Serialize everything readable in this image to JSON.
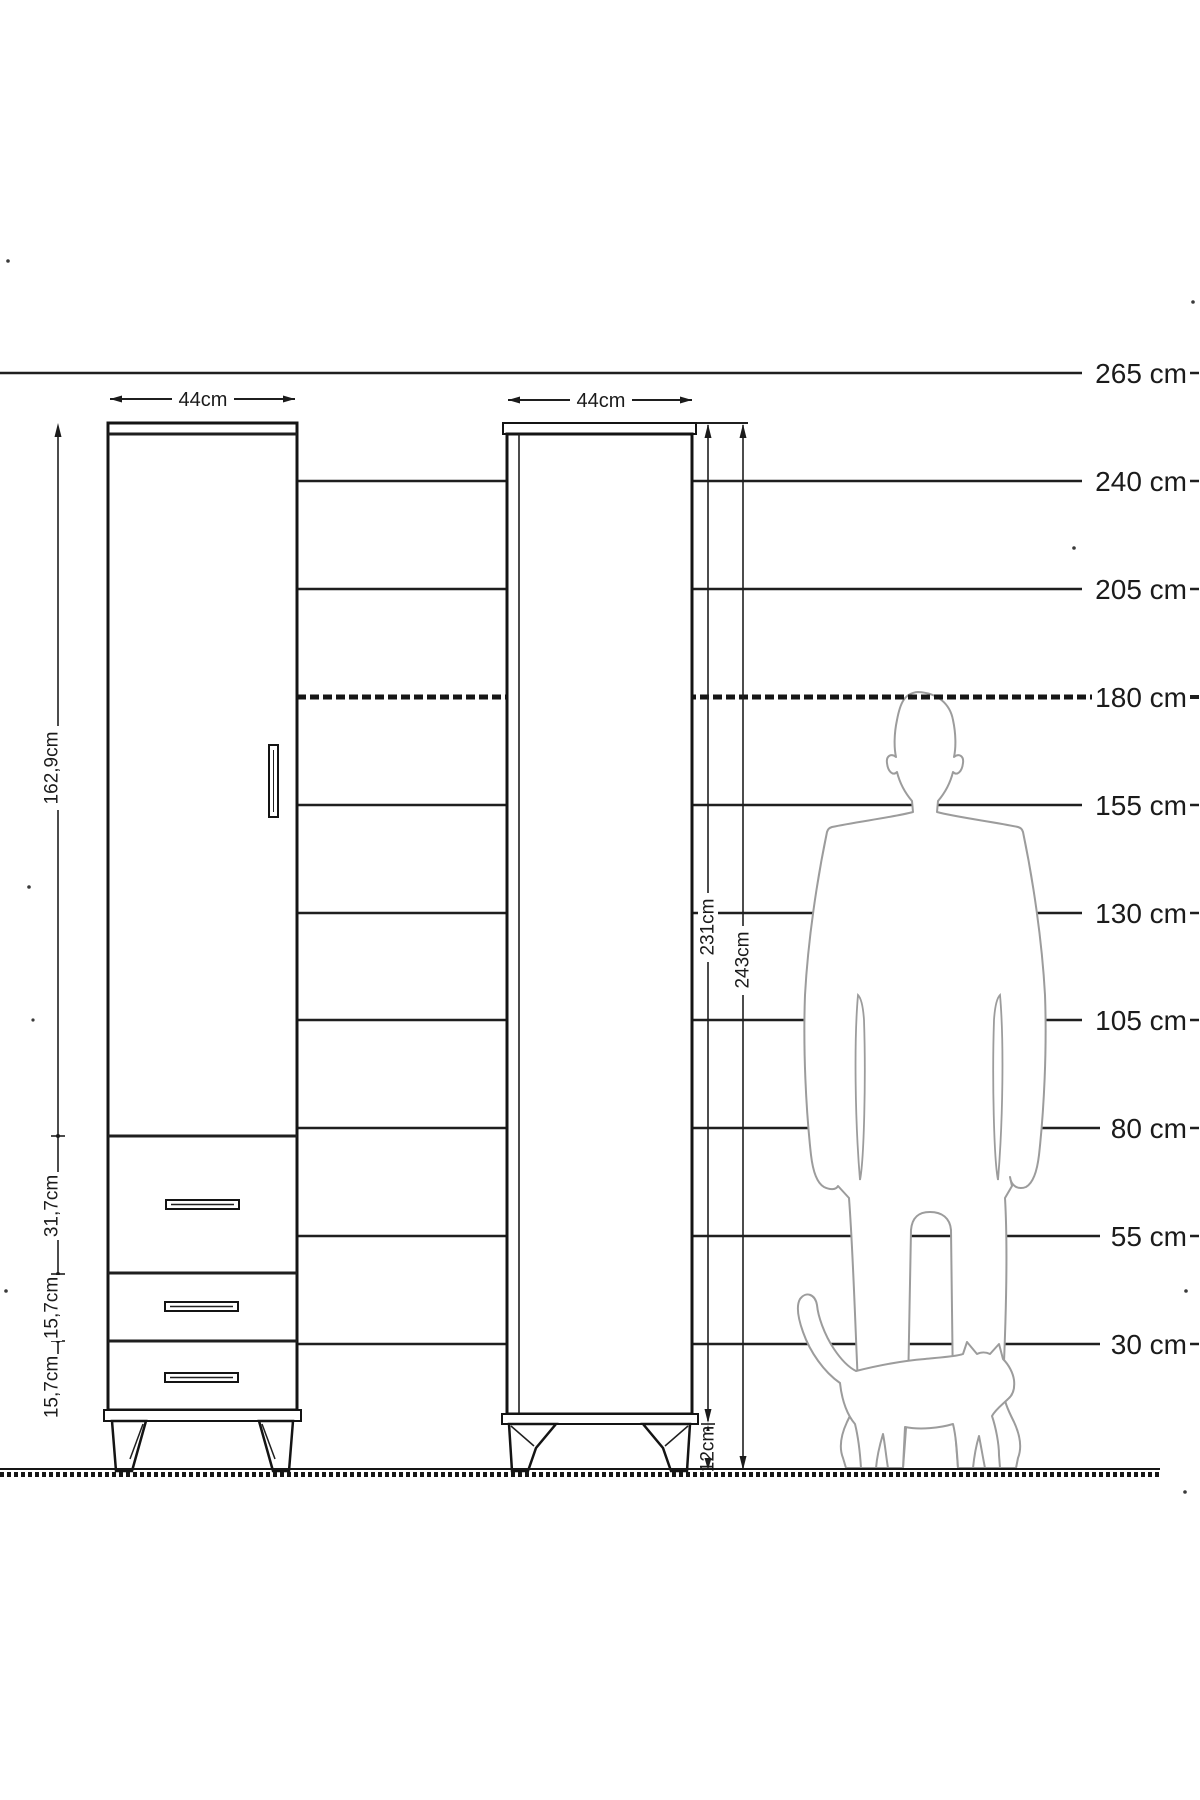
{
  "diagram": {
    "title": "wardrobe-height-dimension-diagram",
    "scale_ruler": {
      "unit": "cm",
      "labels": [
        "265 cm",
        "240 cm",
        "205 cm",
        "180 cm",
        "155 cm",
        "130 cm",
        "105 cm",
        "80 cm",
        "55 cm",
        "30 cm"
      ],
      "dashed_level": "180 cm"
    },
    "front_view": {
      "width_label": "44cm",
      "door_height_label": "162,9cm",
      "drawer1_height_label": "31,7cm",
      "drawer2_height_label": "15,7cm",
      "drawer3_height_label": "15,7cm"
    },
    "side_view": {
      "width_label": "44cm",
      "body_height_label": "231cm",
      "total_height_label": "243cm",
      "leg_height_label": "12cm"
    },
    "figures": {
      "man": "man-silhouette-180cm",
      "cat": "cat-silhouette"
    },
    "line_color": "#1f1f1f",
    "figure_color": "#9c9c9c"
  }
}
